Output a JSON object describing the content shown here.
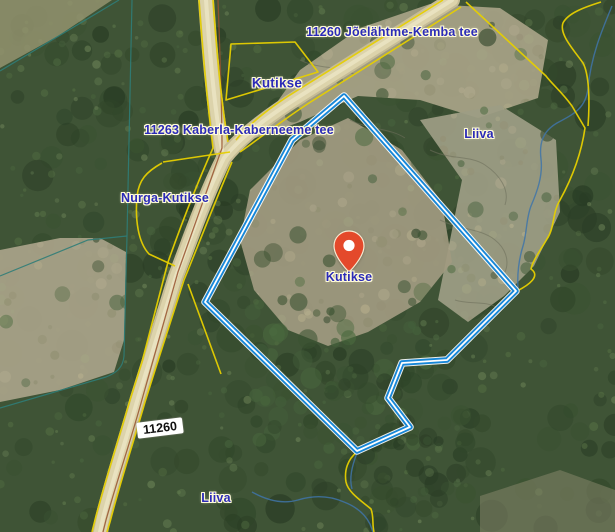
{
  "app": {
    "name": "aerial-cadastral-map-view"
  },
  "map": {
    "marker": {
      "label": "Kutikse",
      "color": "#e4492b",
      "x": 349,
      "y": 272
    },
    "labels": [
      {
        "id": "road-top",
        "text": "11260 Jõelähtme-Kemba tee",
        "x": 392,
        "y": 32,
        "kind": "text"
      },
      {
        "id": "parcel-kutikse-north",
        "text": "Kutikse",
        "x": 277,
        "y": 83,
        "kind": "text-big"
      },
      {
        "id": "road-cross",
        "text": "11263 Kaberla-Kaberneeme tee",
        "x": 239,
        "y": 130,
        "kind": "text"
      },
      {
        "id": "parcel-liiva-east",
        "text": "Liiva",
        "x": 479,
        "y": 134,
        "kind": "text"
      },
      {
        "id": "parcel-nurga-kutikse",
        "text": "Nurga-Kutikse",
        "x": 165,
        "y": 198,
        "kind": "text"
      },
      {
        "id": "road-shield",
        "text": "11260",
        "x": 160,
        "y": 428,
        "kind": "shield"
      },
      {
        "id": "parcel-liiva-south",
        "text": "Liiva",
        "x": 216,
        "y": 498,
        "kind": "text"
      }
    ],
    "colors": {
      "selected_parcel_boundary": "#1787d8",
      "boundary_core": "#ffffff",
      "cadastral_line": "#e6cf00",
      "road_parcel_line": "#96522e",
      "green_network_line": "#2f7d78",
      "stream_line": "#3f74a8",
      "label_text": "#2b2bb8",
      "label_halo": "#fffbd8",
      "marker": "#e4492b",
      "road_fill": "#dcd3ab",
      "forest": "#3f5436",
      "clearing": "#a8a287"
    }
  }
}
